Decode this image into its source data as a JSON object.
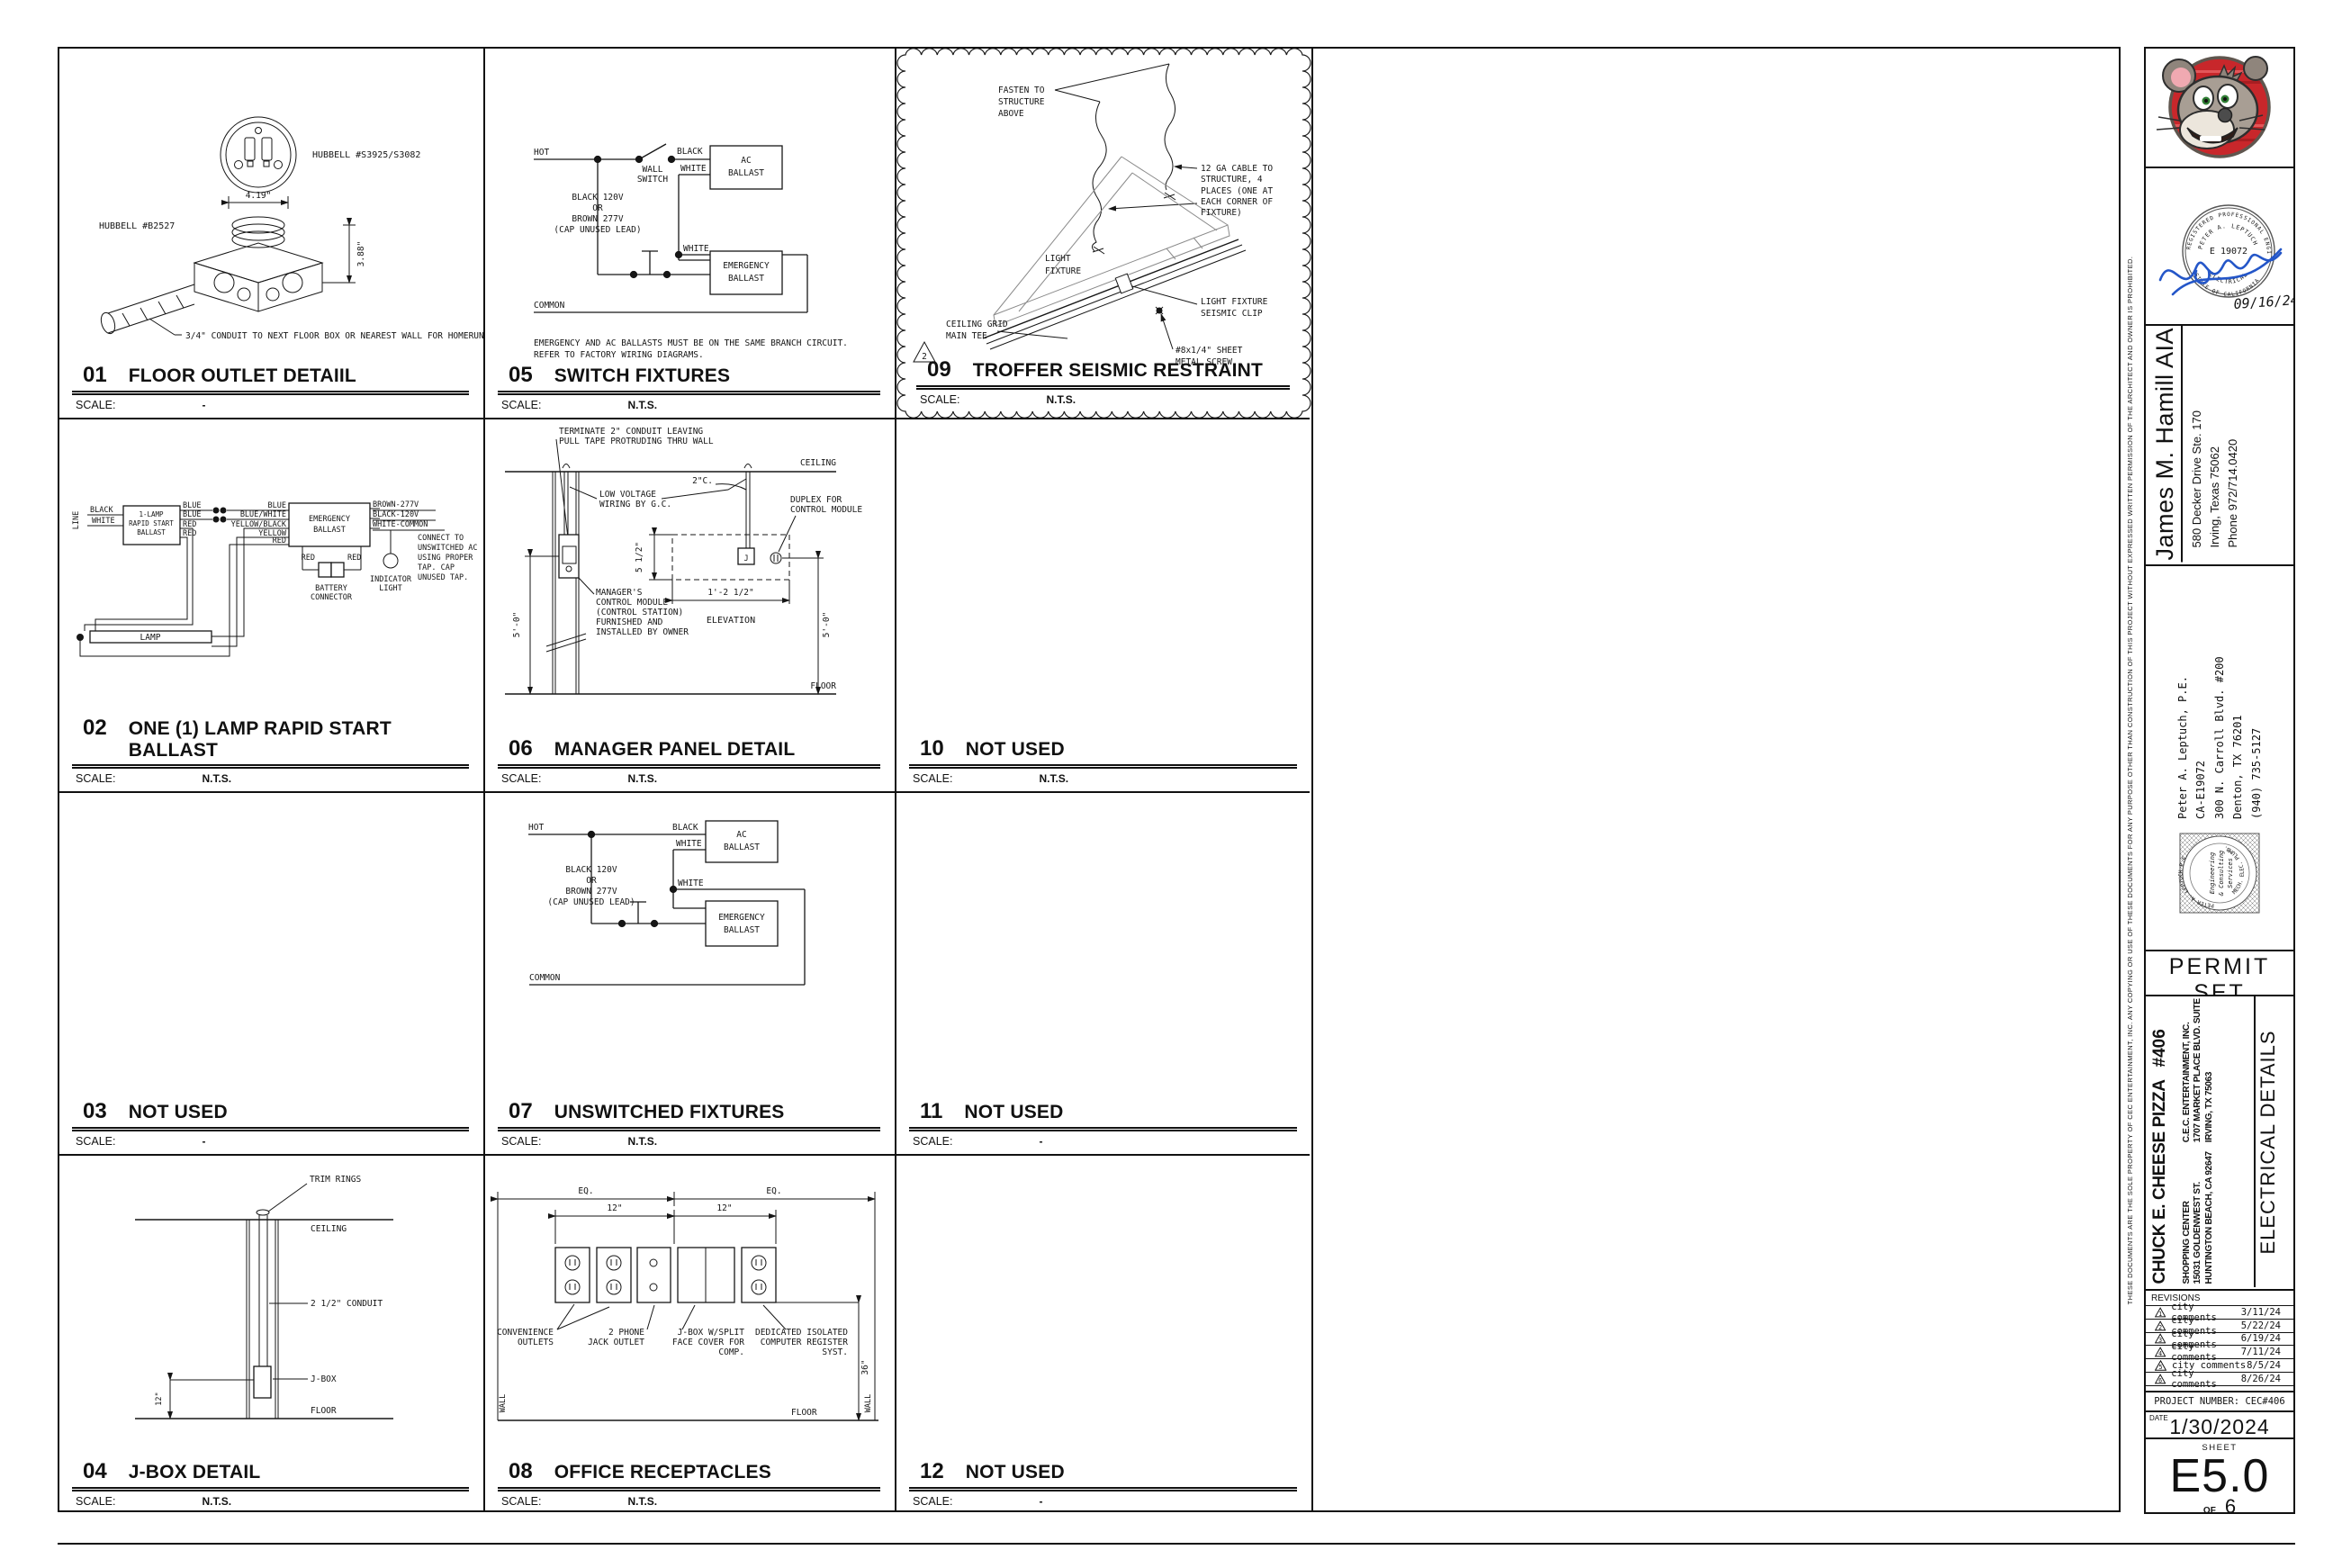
{
  "scale_label": "SCALE:",
  "d01": {
    "num": "01",
    "title": "FLOOR OUTLET DETAIIL",
    "scale": "-",
    "hubbell_top": "HUBBELL #S3925/S3082",
    "hubbell_box": "HUBBELL #B2527",
    "dim_w": "4.19\"",
    "dim_h": "3.88\"",
    "conduit": "3/4\" CONDUIT TO NEXT FLOOR BOX OR NEAREST WALL FOR HOMERUN",
    "note": "REFER TO MANUFACTURER TECHNICAL INSTALLATION FOR CONCRETE FLOORS"
  },
  "d02": {
    "num": "02",
    "title": "ONE (1) LAMP RAPID START BALLAST",
    "scale": "N.T.S.",
    "line": "LINE",
    "black": "BLACK",
    "white": "WHITE",
    "ballast": [
      "1-LAMP",
      "RAPID START",
      "BALLAST"
    ],
    "out": [
      "BLUE",
      "BLUE",
      "RED",
      "RED"
    ],
    "mid": [
      "BLUE",
      "BLUE/WHITE",
      "YELLOW/BLACK",
      "YELLOW",
      "RED"
    ],
    "em": [
      "EMERGENCY",
      "BALLAST"
    ],
    "taps": [
      "BROWN-277V",
      "BLACK-120V",
      "WHITE-COMMON"
    ],
    "connect": [
      "CONNECT TO",
      "UNSWITCHED AC",
      "USING PROPER",
      "TAP. CAP",
      "UNUSED TAP."
    ],
    "red_l": "RED",
    "red_r": "RED",
    "battery": [
      "BATTERY",
      "CONNECTOR"
    ],
    "indicator": [
      "INDICATOR",
      "LIGHT"
    ],
    "lamp": "LAMP"
  },
  "d03": {
    "num": "03",
    "title": "NOT USED",
    "scale": "-"
  },
  "d04": {
    "num": "04",
    "title": "J-BOX DETAIL",
    "scale": "N.T.S.",
    "trim": "TRIM RINGS",
    "ceiling": "CEILING",
    "conduit": "2 1/2\" CONDUIT",
    "jbox": "J-BOX",
    "dim12": "12\"",
    "floor": "FLOOR"
  },
  "d05": {
    "num": "05",
    "title": "SWITCH FIXTURES",
    "scale": "N.T.S.",
    "hot": "HOT",
    "black": "BLACK",
    "white1": "WHITE",
    "white2": "WHITE",
    "wall_switch": [
      "WALL",
      "SWITCH"
    ],
    "volt": [
      "BLACK 120V",
      "OR",
      "BROWN 277V",
      "(CAP UNUSED LEAD)"
    ],
    "ac": [
      "AC",
      "BALLAST"
    ],
    "em": [
      "EMERGENCY",
      "BALLAST"
    ],
    "common": "COMMON",
    "note": [
      "EMERGENCY AND AC BALLASTS MUST BE ON THE SAME BRANCH CIRCUIT.",
      "REFER TO FACTORY WIRING DIAGRAMS."
    ]
  },
  "d06": {
    "num": "06",
    "title": "MANAGER PANEL DETAIL",
    "scale": "N.T.S.",
    "note": [
      "TERMINATE 2\" CONDUIT LEAVING",
      "PULL TAPE PROTRUDING THRU WALL"
    ],
    "ceiling": "CEILING",
    "c2": "2\"C.",
    "lv": [
      "LOW VOLTAGE",
      "WIRING BY G.C."
    ],
    "duplex": [
      "DUPLEX FOR",
      "CONTROL MODULE"
    ],
    "j": "J",
    "dim55": "5 1/2\"",
    "dim125": "1'-2 1/2\"",
    "mgr": [
      "MANAGER'S",
      "CONTROL MODULE",
      "(CONTROL STATION)",
      "FURNISHED AND",
      "INSTALLED BY OWNER"
    ],
    "elev": "ELEVATION",
    "dim50l": "5'-0\"",
    "dim50r": "5'-0\"",
    "floor": "FLOOR"
  },
  "d07": {
    "num": "07",
    "title": "UNSWITCHED FIXTURES",
    "scale": "N.T.S.",
    "hot": "HOT",
    "black": "BLACK",
    "white1": "WHITE",
    "white2": "WHITE",
    "volt": [
      "BLACK 120V",
      "OR",
      "BROWN 277V",
      "(CAP UNUSED LEAD)"
    ],
    "ac": [
      "AC",
      "BALLAST"
    ],
    "em": [
      "EMERGENCY",
      "BALLAST"
    ],
    "common": "COMMON"
  },
  "d08": {
    "num": "08",
    "title": "OFFICE RECEPTACLES",
    "scale": "N.T.S.",
    "eq1": "EQ.",
    "eq2": "EQ.",
    "d12a": "12\"",
    "d12b": "12\"",
    "conv": [
      "CONVENIENCE",
      "OUTLETS"
    ],
    "phone": [
      "2 PHONE",
      "JACK OUTLET"
    ],
    "jbox": [
      "J-BOX W/SPLIT",
      "FACE COVER FOR",
      "COMP."
    ],
    "ded": [
      "DEDICATED ISOLATED",
      "COMPUTER REGISTER",
      "SYST."
    ],
    "wall_l": "WALL",
    "wall_r": "WALL",
    "dim36": "36\"",
    "floor": "FLOOR"
  },
  "d09": {
    "num": "09",
    "title": "TROFFER SEISMIC RESTRAINT",
    "scale": "N.T.S.",
    "fasten": [
      "FASTEN TO",
      "STRUCTURE",
      "ABOVE"
    ],
    "cable": [
      "12 GA CABLE TO",
      "STRUCTURE, 4",
      "PLACES (ONE AT",
      "EACH CORNER OF",
      "FIXTURE)"
    ],
    "fixture": [
      "LIGHT",
      "FIXTURE"
    ],
    "clip": [
      "LIGHT FIXTURE",
      "SEISMIC CLIP"
    ],
    "grid": [
      "CEILING GRID",
      "MAIN TEE"
    ],
    "screw": [
      "#8x1/4\" SHEET",
      "METAL SCREW"
    ],
    "rev": "2"
  },
  "d10": {
    "num": "10",
    "title": "NOT USED",
    "scale": "N.T.S."
  },
  "d11": {
    "num": "11",
    "title": "NOT USED",
    "scale": "-"
  },
  "d12": {
    "num": "12",
    "title": "NOT USED",
    "scale": "-"
  },
  "tb": {
    "stamp": {
      "arc_top": "REGISTERED PROFESSIONAL ENGINEER",
      "name": "PETER A. LEPTUCH",
      "num": "E 19072",
      "field": "ELECTRICAL",
      "state": "STATE OF CALIFORNIA",
      "sig_date": "09/16/24"
    },
    "architect": {
      "name": "James M. Hamill AIA",
      "addr": [
        "580 Decker Drive Ste. 170",
        "Irving, Texas 75062",
        "Phone 972/714.0420"
      ]
    },
    "engineer": {
      "lines": [
        "Peter A. Leptuch, P.E.",
        "CA-E19072",
        "300 N. Carroll Blvd. #200",
        "Denton, TX 76201",
        "(940) 735-5127"
      ],
      "seal_arc_top": "PETER A. LEPTUCH P.E.",
      "seal_arc_bot": "MECH. ELEC. PLUMB.",
      "seal_center": [
        "Engineering",
        "& Consulting",
        "Services"
      ]
    },
    "permit": {
      "title": "PERMIT SET",
      "sub": [
        "THIS IS A PERMIT ISSUE SET AS DEFINED BY GUIDELINES",
        "AND PROCESS ESTABLISHED BY CEC ENTERTAINMENT, INC."
      ]
    },
    "project": {
      "name": "CHUCK E. CHEESE PIZZA",
      "number": "#406",
      "site": [
        "SHOPPING CENTER",
        "15031 GOLDENWEST ST.",
        "HUNTINGTON BEACH, CA 92647"
      ],
      "owner": [
        "C.E.C. ENTERTAINMENT, INC.",
        "1707 MARKET PLACE BLVD. SUITE 200",
        "IRVING, TX 75063"
      ],
      "city": [
        "HUNTINGTON",
        "BEACH, CA"
      ]
    },
    "sheet_title": "ELECTRICAL DETAILS",
    "revisions": {
      "header": "REVISIONS",
      "rows": [
        [
          "1",
          "city comments",
          "3/11/24"
        ],
        [
          "2",
          "city comments",
          "5/22/24"
        ],
        [
          "3",
          "city comments",
          "6/19/24"
        ],
        [
          "4",
          "city comments",
          "7/11/24"
        ],
        [
          "5",
          "city comments",
          "8/5/24"
        ],
        [
          "6",
          "city comments",
          "8/26/24"
        ]
      ]
    },
    "project_number": "PROJECT NUMBER: CEC#406",
    "date_label": "DATE",
    "date": "1/30/2024",
    "sheet_label": "SHEET",
    "sheet_no": "E5.0",
    "of": "OF",
    "total": "6",
    "disclaimer": "THESE DOCUMENTS ARE THE SOLE PROPERTY OF CEC ENTERTAINMENT, INC. ANY COPYING OR USE OF THESE DOCUMENTS FOR ANY PURPOSE OTHER THAN CONSTRUCTION OF THIS PROJECT WITHOUT EXPRESSED WRITTEN PERMISSION OF THE ARCHITECT AND OWNER IS PROHIBITED."
  }
}
